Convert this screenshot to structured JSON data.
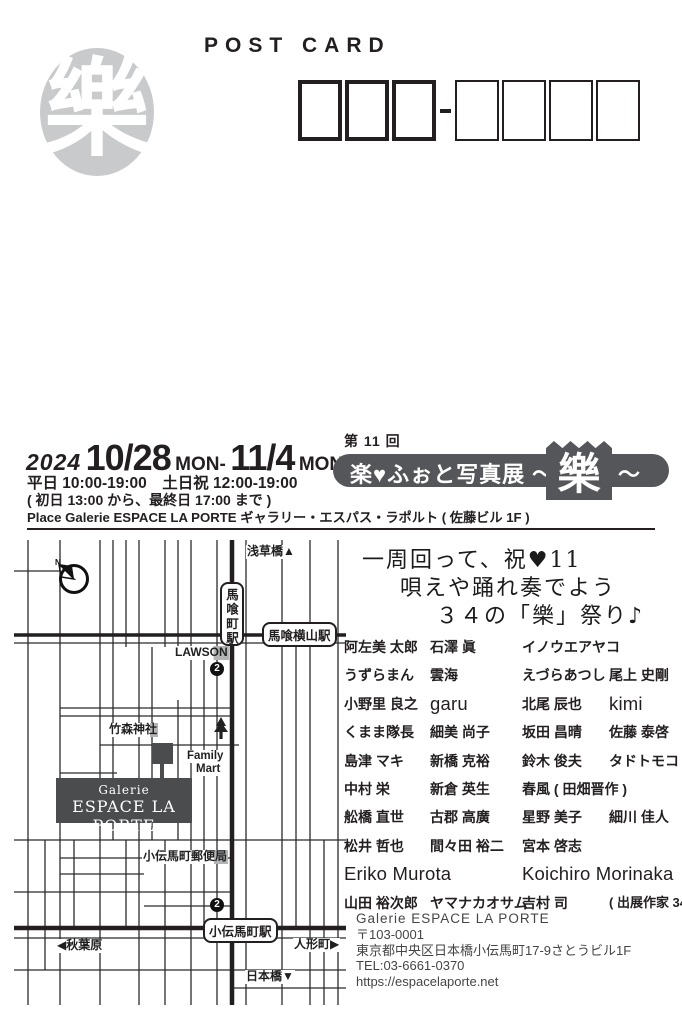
{
  "colors": {
    "ink": "#231f20",
    "stamp_gray": "#c9cacb",
    "badge_gray": "#55565a",
    "map_dark_gray": "#4b4c4e",
    "label_highlight_gray": "#b3b4b6"
  },
  "header": {
    "post_card": "POST CARD",
    "stamp_char": "樂"
  },
  "event": {
    "year": "2024",
    "date_start": "10/28",
    "sep": "MON-",
    "date_end": "11/4",
    "day_end": "MON",
    "hours": "平日 10:00-19:00　土日祝 12:00-19:00",
    "note": "( 初日 13:00 から、最終日 17:00 まで )",
    "place": "Place  Galerie ESPACE LA PORTE ギャラリー・エスパス・ラポルト ( 佐藤ビル 1F )",
    "session": "第 11 回",
    "title_left": "楽♥ふぉと写真展 ～",
    "title_kanji": "樂",
    "title_tail": "～"
  },
  "headline": {
    "line1": "一周回って、祝♥11",
    "line2": "唄えや踊れ奏でよう",
    "line3": "３４の「樂」祭り♪"
  },
  "artists": {
    "rows": [
      [
        {
          "t": "阿左美 太郎"
        },
        {
          "t": "石澤 眞"
        },
        {
          "t": "イノウエアヤコ",
          "span": 2
        }
      ],
      [
        {
          "t": "うずらまん"
        },
        {
          "t": "雲海"
        },
        {
          "t": "えづらあつし"
        },
        {
          "t": "尾上 史剛"
        }
      ],
      [
        {
          "t": "小野里 良之"
        },
        {
          "t": "garu",
          "latin": true
        },
        {
          "t": "北尾 辰也"
        },
        {
          "t": "kimi",
          "latin": true
        }
      ],
      [
        {
          "t": "くまま隊長"
        },
        {
          "t": "細美 尚子"
        },
        {
          "t": "坂田 昌晴"
        },
        {
          "t": "佐藤 泰啓"
        }
      ],
      [
        {
          "t": "島津 マキ"
        },
        {
          "t": "新橋 克裕"
        },
        {
          "t": "鈴木 俊夫"
        },
        {
          "t": "タドトモコ"
        }
      ],
      [
        {
          "t": "中村 栄"
        },
        {
          "t": "新倉 英生"
        },
        {
          "t": "春風 ( 田畑晋作 )",
          "span": 2
        }
      ],
      [
        {
          "t": "舩橋 直世"
        },
        {
          "t": "古郡 高廣"
        },
        {
          "t": "星野 美子"
        },
        {
          "t": "細川 佳人"
        }
      ],
      [
        {
          "t": "松井 哲也"
        },
        {
          "t": "間々田 裕二"
        },
        {
          "t": "宮本 啓志",
          "span": 2
        }
      ],
      [
        {
          "t": "Eriko Murota",
          "latin": true,
          "span": 2
        },
        {
          "t": "Koichiro Morinaka",
          "latin": true,
          "span": 2
        }
      ],
      [
        {
          "t": "山田 裕次郎"
        },
        {
          "t": "ヤマナカオサム"
        },
        {
          "t": "吉村 司"
        },
        {
          "t": "( 出展作家 34 名 )",
          "small": true
        }
      ]
    ]
  },
  "map": {
    "compass_label": "N",
    "labels": {
      "asakusabashi": "浅草橋▲",
      "bakurocho_station": "馬喰町駅",
      "bakuroyokoyama_station": "馬喰横山駅",
      "lawson": "LAWSON",
      "exit_top": "2",
      "takemori_shrine": "竹森神社",
      "family_mart_line1": "Family",
      "family_mart_line2": "Mart",
      "gallery_line1": "Galerie",
      "gallery_line2": "ESPACE LA PORTE",
      "post_office": "小伝馬町郵便局",
      "exit_bottom": "2",
      "kodenmacho_station": "小伝馬町駅",
      "akihabara": "◀秋葉原",
      "ningyocho": "人形町▶",
      "nihonbashi": "日本橋▼"
    }
  },
  "venue": {
    "name": "Galerie ESPACE LA PORTE",
    "postal": "〒103-0001",
    "address": "東京都中央区日本橋小伝馬町17-9さとうビル1F",
    "tel": "TEL:03-6661-0370",
    "url": "https://espacelaporte.net"
  }
}
